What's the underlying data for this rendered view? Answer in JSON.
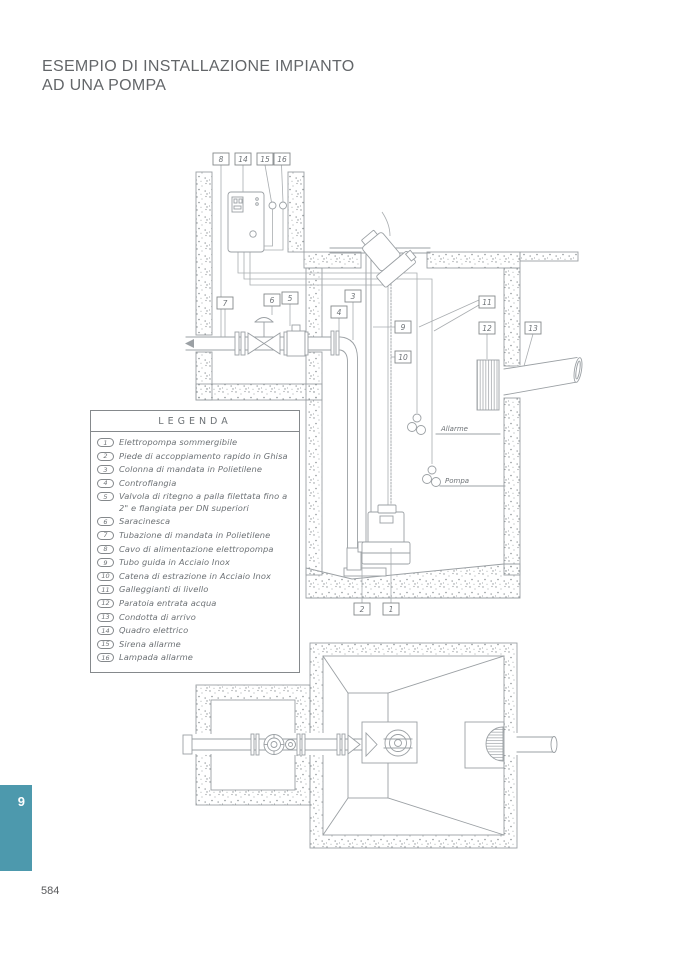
{
  "page": {
    "title_line1": "ESEMPIO DI INSTALLAZIONE IMPIANTO",
    "title_line2": "AD UNA POMPA",
    "section_tab": "9",
    "page_number": "584"
  },
  "colors": {
    "accent_teal": "#4d99ad",
    "title_gray": "#636669",
    "line_gray": "#9ba0a4"
  },
  "legend": {
    "title": "LEGENDA",
    "items": [
      {
        "num": "1",
        "text": "Elettropompa sommergibile"
      },
      {
        "num": "2",
        "text": "Piede di accoppiamento rapido in Ghisa"
      },
      {
        "num": "3",
        "text": "Colonna di mandata in Polietilene"
      },
      {
        "num": "4",
        "text": "Controflangia"
      },
      {
        "num": "5",
        "text": "Valvola di ritegno a palla  filettata fino a 2\" e flangiata per DN superiori"
      },
      {
        "num": "6",
        "text": "Saracinesca"
      },
      {
        "num": "7",
        "text": "Tubazione di mandata in Polietilene"
      },
      {
        "num": "8",
        "text": "Cavo di alimentazione elettropompa"
      },
      {
        "num": "9",
        "text": "Tubo guida in Acciaio Inox"
      },
      {
        "num": "10",
        "text": "Catena di estrazione in Acciaio Inox"
      },
      {
        "num": "11",
        "text": "Galleggianti di livello"
      },
      {
        "num": "12",
        "text": "Paratoia entrata acqua"
      },
      {
        "num": "13",
        "text": "Condotta di arrivo"
      },
      {
        "num": "14",
        "text": "Quadro elettrico"
      },
      {
        "num": "15",
        "text": "Sirena allarme"
      },
      {
        "num": "16",
        "text": "Lampada allarme"
      }
    ]
  },
  "diagram": {
    "callouts": {
      "n1": "1",
      "n2": "2",
      "n3": "3",
      "n4": "4",
      "n5": "5",
      "n6": "6",
      "n7": "7",
      "n8": "8",
      "n9": "9",
      "n10": "10",
      "n11": "11",
      "n12": "12",
      "n13": "13",
      "n14": "14",
      "n15": "15",
      "n16": "16"
    },
    "labels": {
      "alarm": "Allarme",
      "pump": "Pompa"
    }
  }
}
